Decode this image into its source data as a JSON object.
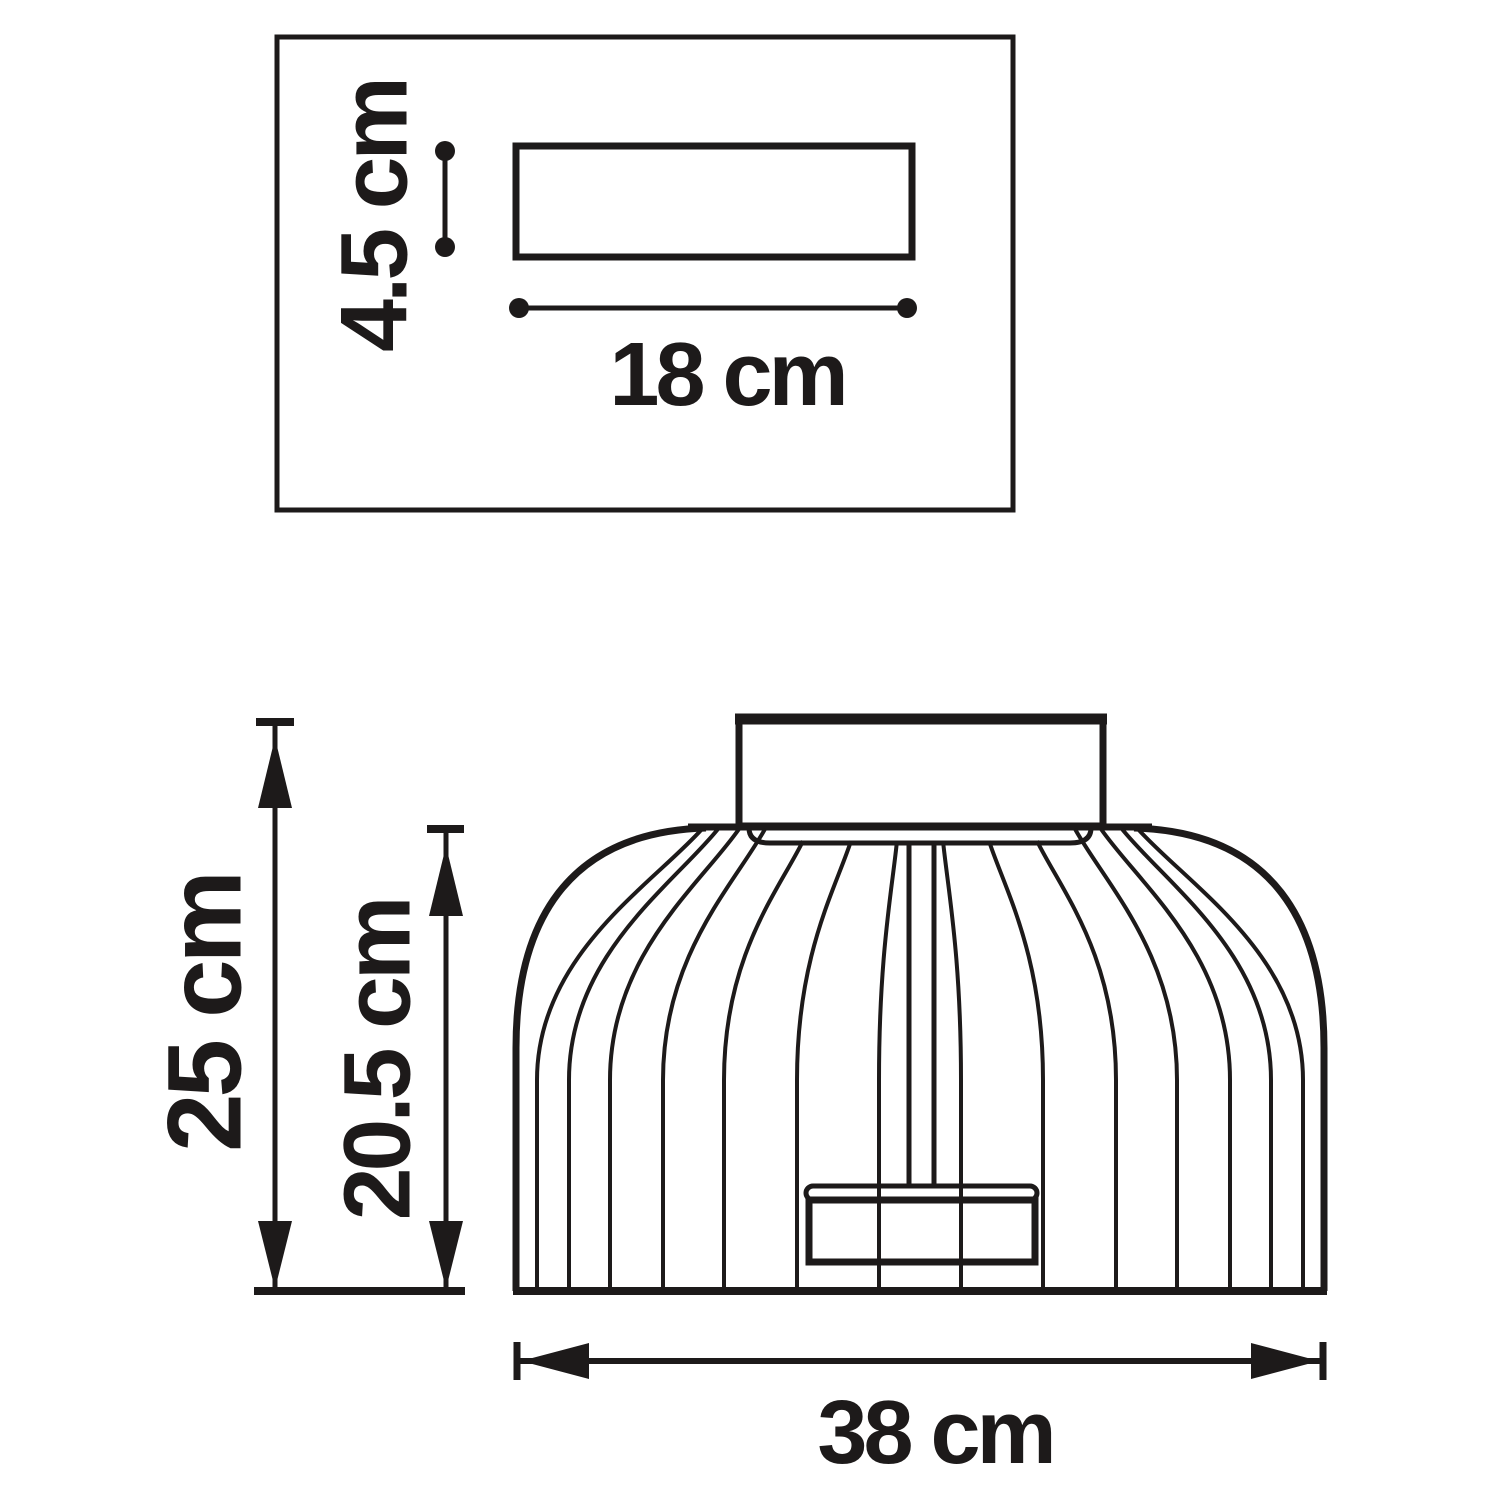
{
  "diagram": {
    "type": "product dimension drawing",
    "subject": "ribbed ceiling lamp - top view and front view",
    "colors": {
      "line": "#1d1a1a",
      "background": "#ffffff"
    },
    "top_view": {
      "plate_height_label": "4.5 cm",
      "plate_width_label": "18 cm"
    },
    "front_view": {
      "total_height_label": "25 cm",
      "shade_height_label": "20.5 cm",
      "diameter_label": "38 cm"
    }
  }
}
